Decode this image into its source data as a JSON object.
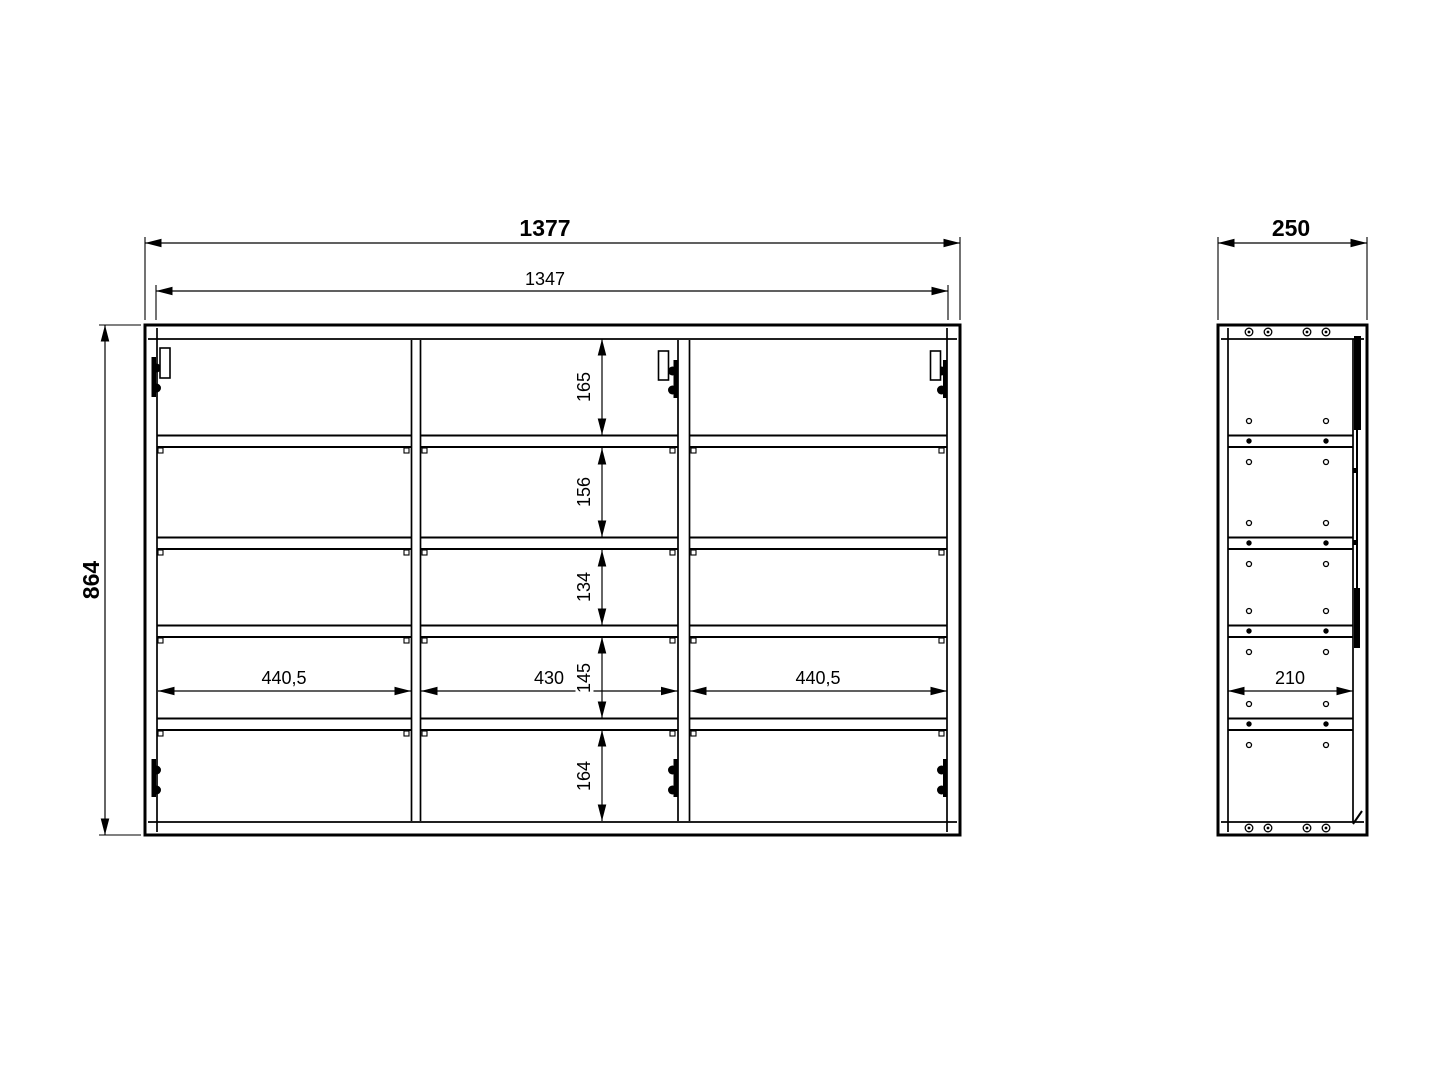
{
  "drawing": {
    "front_view": {
      "overall_width": "1377",
      "inner_width": "1347",
      "overall_height": "864",
      "compartment_widths": [
        "440,5",
        "430",
        "440,5"
      ],
      "row_heights_top_to_bottom": [
        "165",
        "156",
        "134",
        "145",
        "164"
      ]
    },
    "side_view": {
      "overall_depth": "250",
      "inner_depth": "210"
    },
    "colors": {
      "line": "#000000",
      "background": "#ffffff"
    }
  }
}
